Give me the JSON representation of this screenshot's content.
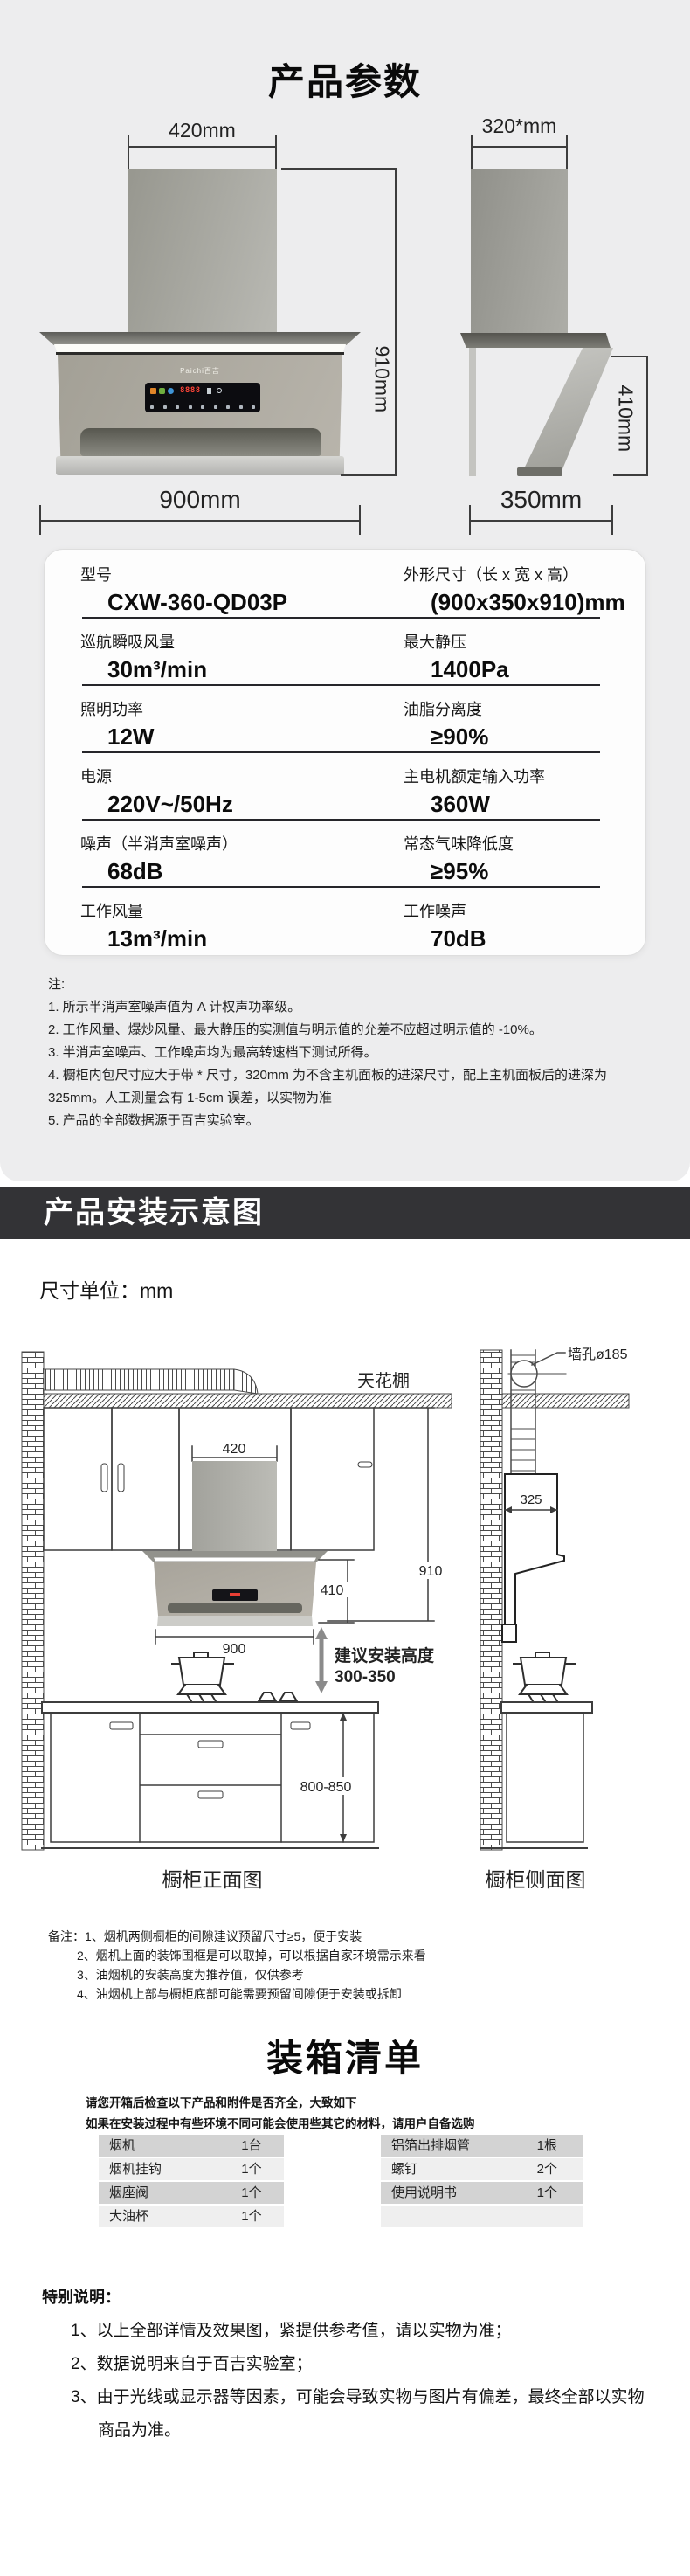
{
  "colors": {
    "banner_bg": "#333336",
    "page_gray": "#ededee",
    "display_red": "#ff4438"
  },
  "params": {
    "title": "产品参数",
    "front": {
      "top_width": "420mm",
      "height": "910mm",
      "width": "900mm",
      "brand": "Paichi百吉",
      "display_value": "8888"
    },
    "side": {
      "top_depth": "320*mm",
      "height": "410mm",
      "depth": "350mm"
    },
    "spec_rows": [
      [
        {
          "label": "型号",
          "value": "CXW-360-QD03P"
        },
        {
          "label": "外形尺寸（长 x 宽 x 高）",
          "value": "(900x350x910)mm"
        }
      ],
      [
        {
          "label": "巡航瞬吸风量",
          "value": "30m³/min"
        },
        {
          "label": "最大静压",
          "value": "1400Pa"
        }
      ],
      [
        {
          "label": "照明功率",
          "value": "12W"
        },
        {
          "label": "油脂分离度",
          "value": "≥90%"
        }
      ],
      [
        {
          "label": "电源",
          "value": "220V~/50Hz"
        },
        {
          "label": "主电机额定输入功率",
          "value": "360W"
        }
      ],
      [
        {
          "label": "噪声（半消声室噪声）",
          "value": "68dB"
        },
        {
          "label": "常态气味降低度",
          "value": "≥95%"
        }
      ],
      [
        {
          "label": "工作风量",
          "value": "13m³/min"
        },
        {
          "label": "工作噪声",
          "value": "70dB"
        }
      ]
    ],
    "notes_title": "注:",
    "notes": [
      "1. 所示半消声室噪声值为 A 计权声功率级。",
      "2. 工作风量、爆炒风量、最大静压的实测值与明示值的允差不应超过明示值的 -10%。",
      "3. 半消声室噪声、工作噪声均为最高转速档下测试所得。",
      "4. 橱柜内包尺寸应大于带 * 尺寸，320mm 为不含主机面板的进深尺寸，配上主机面板后的进深为 325mm。人工测量会有 1-5cm 误差，以实物为准",
      "5. 产品的全部数据源于百吉实验室。"
    ]
  },
  "install": {
    "banner": "产品安装示意图",
    "unit": "尺寸单位：mm",
    "labels": {
      "ceiling": "天花棚",
      "wall_hole": "墙孔ø185",
      "chimney_width": "420",
      "total_height": "910",
      "hood_height": "410",
      "hood_width": "900",
      "depth": "325",
      "install_height_line1": "建议安装高度",
      "install_height_line2": "300-350",
      "counter_height": "800-850",
      "front_caption": "橱柜正面图",
      "side_caption": "橱柜侧面图"
    },
    "remarks_title": "备注：",
    "remarks": [
      "1、烟机两侧橱柜的间隙建议预留尺寸≥5，便于安装",
      "2、烟机上面的装饰围框是可以取掉，可以根据自家环境需示来看",
      "3、油烟机的安装高度为推荐值，仅供参考",
      "4、油烟机上部与橱柜底部可能需要预留间隙便于安装或拆卸"
    ]
  },
  "packing": {
    "title": "装箱清单",
    "intro1": "请您开箱后检查以下产品和附件是否齐全，大致如下",
    "intro2": "如果在安装过程中有些环境不同可能会使用些其它的材料，请用户自备选购",
    "left_items": [
      {
        "name": "烟机",
        "qty": "1台"
      },
      {
        "name": "烟机挂钩",
        "qty": "1个"
      },
      {
        "name": "烟座阀",
        "qty": "1个"
      },
      {
        "name": "大油杯",
        "qty": "1个"
      }
    ],
    "right_items": [
      {
        "name": "铝箔出排烟管",
        "qty": "1根"
      },
      {
        "name": "螺钉",
        "qty": "2个"
      },
      {
        "name": "使用说明书",
        "qty": "1个"
      },
      {
        "name": "",
        "qty": ""
      }
    ]
  },
  "special": {
    "title": "特别说明：",
    "items": [
      "1、以上全部详情及效果图，紧提供参考值，请以实物为准；",
      "2、数据说明来自于百吉实验室；",
      "3、由于光线或显示器等因素，可能会导致实物与图片有偏差，最终全部以实物商品为准。"
    ]
  }
}
